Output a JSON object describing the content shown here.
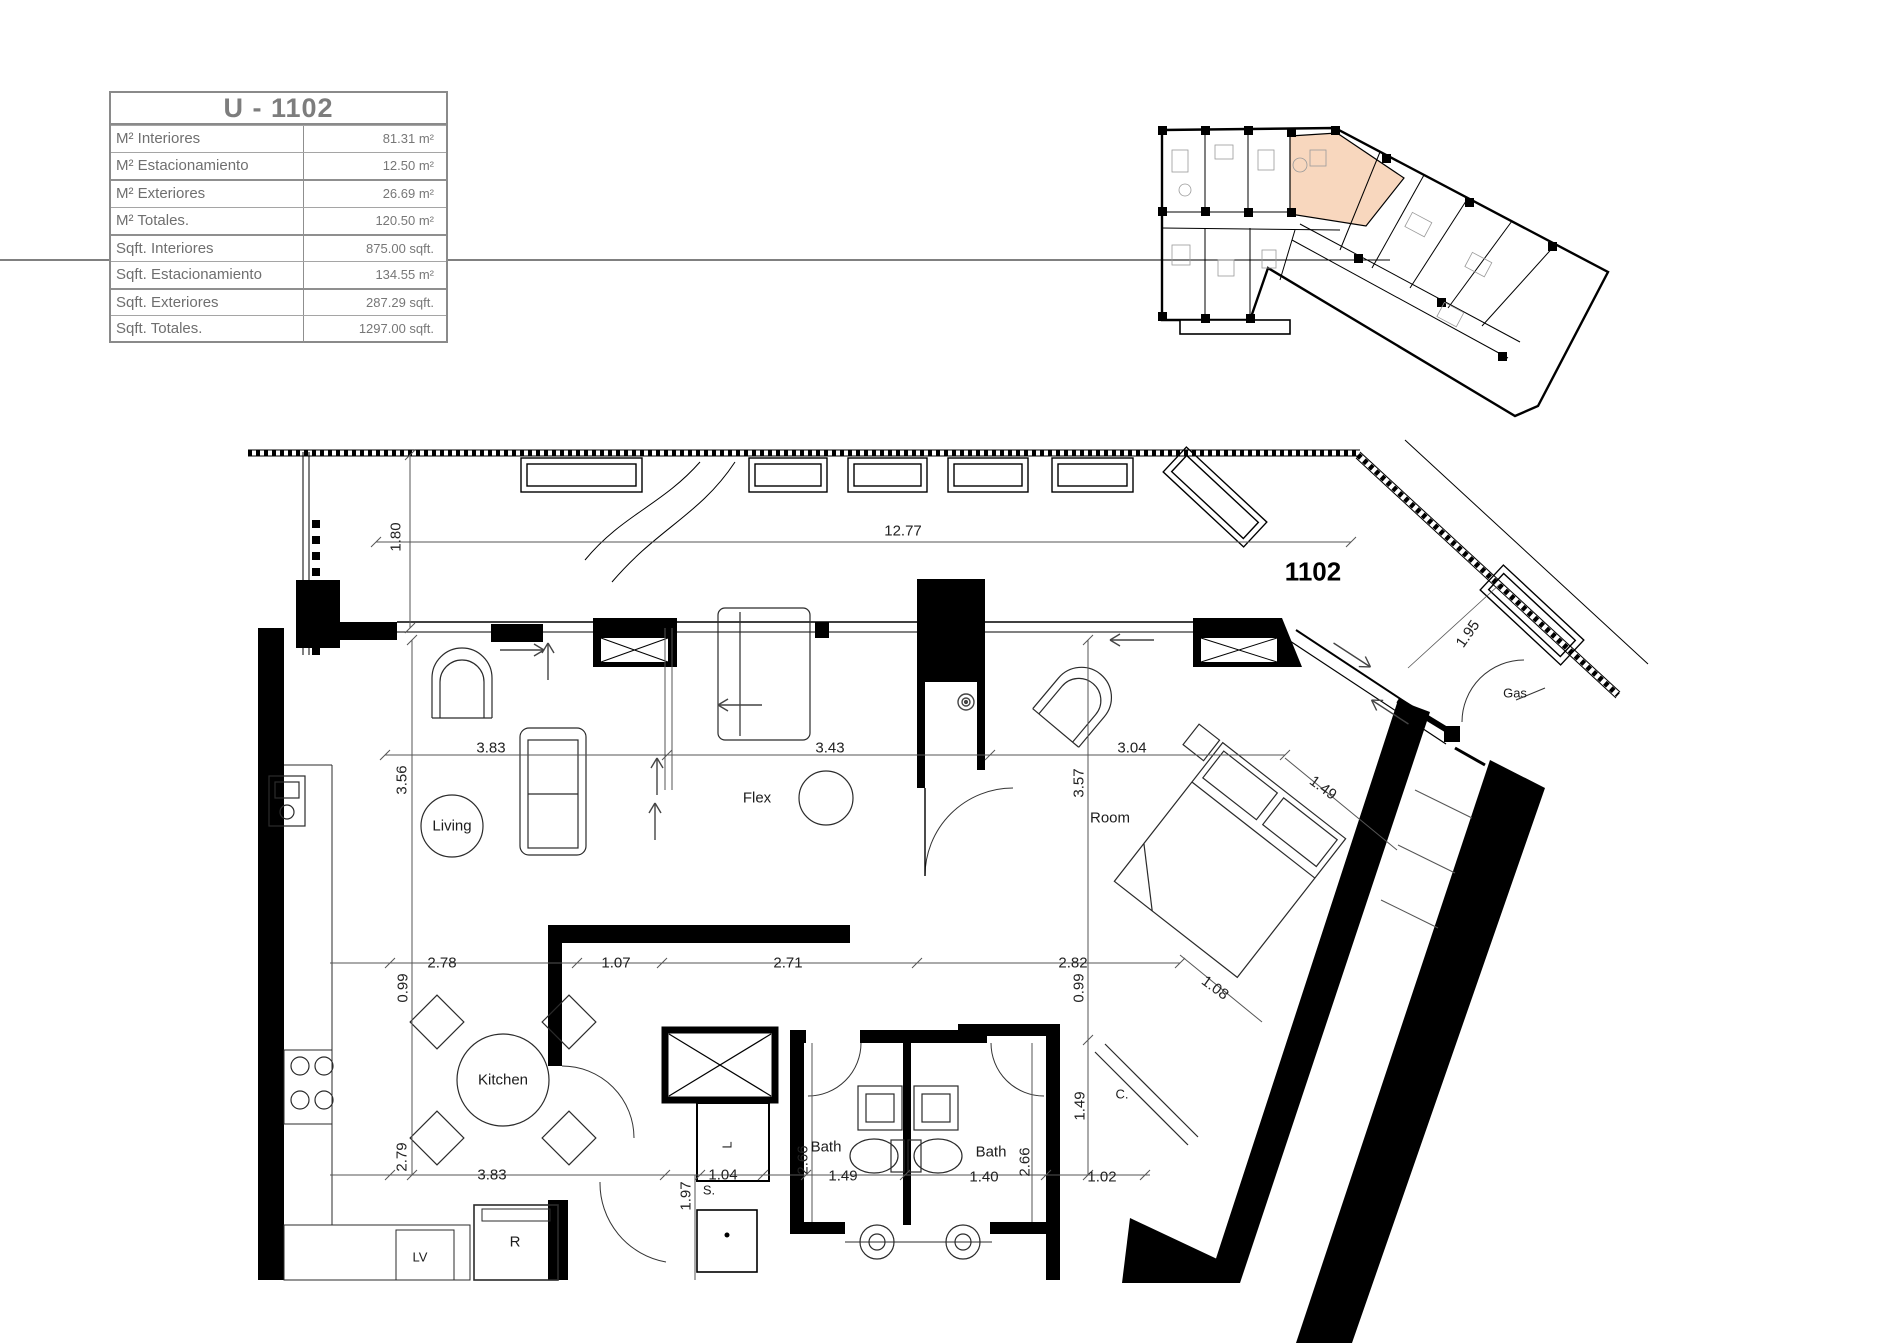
{
  "unit_table": {
    "title": "U - 1102",
    "rows": [
      {
        "label": "M² Interiores",
        "value": "81.31 m²"
      },
      {
        "label": "M² Estacionamiento",
        "value": "12.50 m²"
      },
      {
        "label": "M² Exteriores",
        "value": "26.69 m²"
      },
      {
        "label": "M² Totales.",
        "value": "120.50 m²"
      },
      {
        "label": "Sqft.  Interiores",
        "value": "875.00 sqft."
      },
      {
        "label": "Sqft. Estacionamiento",
        "value": "134.55 m²"
      },
      {
        "label": "Sqft. Exteriores",
        "value": "287.29 sqft."
      },
      {
        "label": "Sqft. Totales.",
        "value": "1297.00 sqft."
      }
    ]
  },
  "key_plan": {
    "highlighted_unit": "1102",
    "highlight_color": "#F8D7BE"
  },
  "floor_plan": {
    "unit_number": "1102",
    "room_labels": {
      "living": "Living",
      "flex": "Flex",
      "room": "Room",
      "kitchen": "Kitchen",
      "bath_left": "Bath",
      "bath_right": "Bath"
    },
    "annotations": {
      "gas": "Gas",
      "closet": "C.",
      "storage": "S.",
      "linen": "L",
      "fridge": "R",
      "dishwasher": "LV"
    },
    "dimensions": {
      "terrace_width": "12.77",
      "terrace_depth": "1.80",
      "entry_side": "1.95",
      "living_width": "3.83",
      "flex_width": "3.43",
      "room_width": "3.04",
      "living_depth": "3.56",
      "room_depth": "3.57",
      "room_diag": "1.49",
      "kitchen_width": "2.78",
      "hall_width": "1.07",
      "flex_lower_width": "2.71",
      "room_lower_width": "2.82",
      "kitchen_side": "0.99",
      "room_side": "0.99",
      "bed_diag": "1.08",
      "kitchen_depth": "2.79",
      "closet_height": "1.49",
      "bath_left_depth": "2.66",
      "bath_right_depth": "2.66",
      "kitchen_lower_width": "3.83",
      "corridor_width": "1.04",
      "bath_left_width": "1.49",
      "bath_right_width": "1.40",
      "closet_width": "1.02",
      "pantry_depth": "1.97"
    }
  }
}
